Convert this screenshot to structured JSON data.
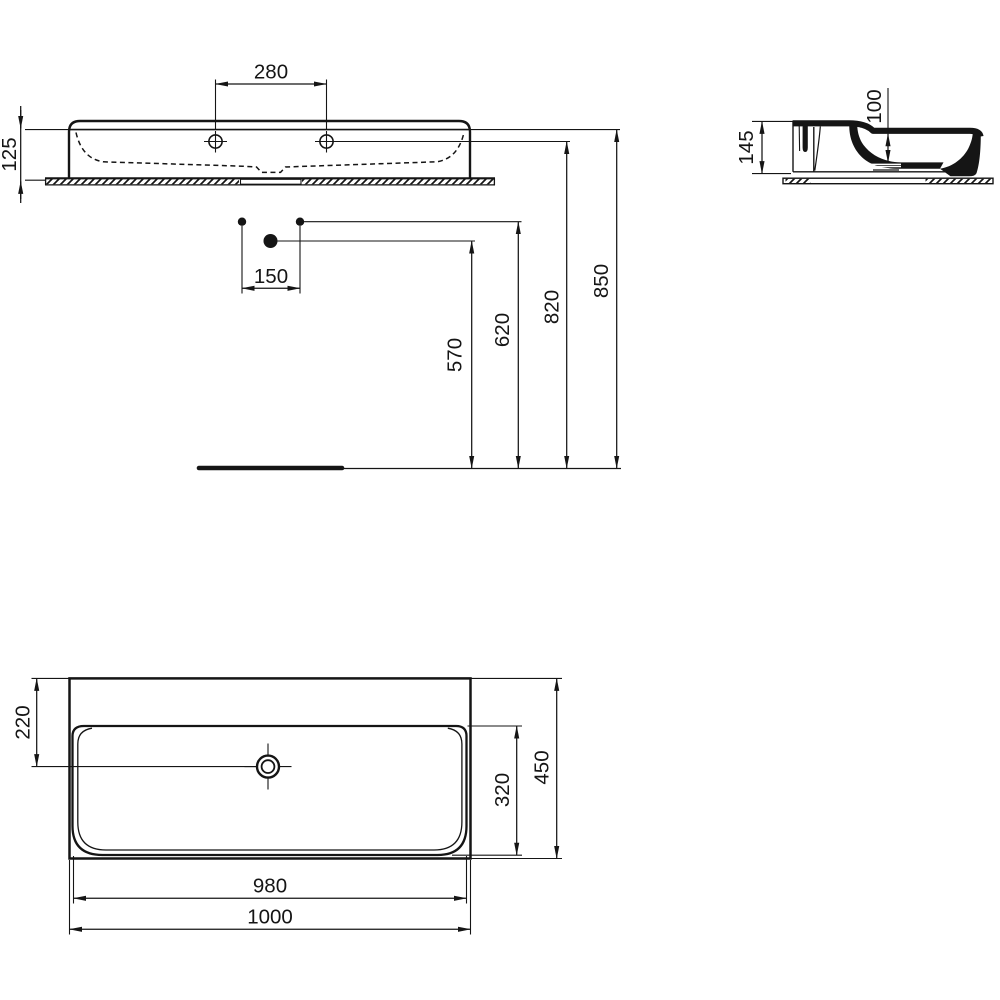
{
  "document": {
    "type": "technical-dimension-drawing",
    "subject": "wall-hung washbasin, three orthographic views",
    "units": "mm",
    "colors": {
      "background": "#ffffff",
      "line": "#151515"
    }
  },
  "views": {
    "front_view": {
      "name": "front elevation with installation heights"
    },
    "side_view": {
      "name": "side cross-section"
    },
    "plan_view": {
      "name": "top plan view"
    }
  },
  "dimensions": {
    "front": {
      "tap_hole_spacing": "280",
      "basin_height": "125",
      "waste_offset": "150",
      "waste_outlet_height": "570",
      "supply_height": "620",
      "tap_hole_height": "820",
      "rim_height": "850"
    },
    "side": {
      "basin_total_height": "145",
      "bowl_depth": "100"
    },
    "plan": {
      "drain_setback": "220",
      "bowl_front_to_back": "320",
      "total_front_to_back": "450",
      "bowl_width": "980",
      "total_width": "1000"
    }
  }
}
